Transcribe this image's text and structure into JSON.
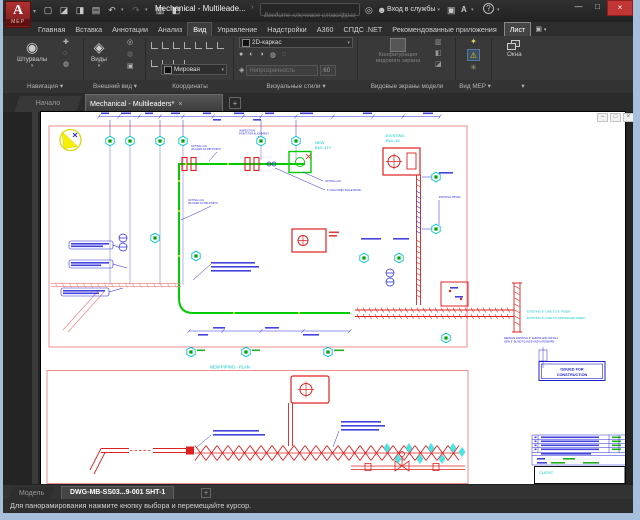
{
  "window": {
    "title": "Mechanical - Multileade..."
  },
  "titlebar": {
    "logo": "A",
    "logo_sub": "MEP",
    "search_placeholder": "Введите ключевое слово/фразу",
    "signin_label": "Вход в службы"
  },
  "icons": {
    "new": "▢",
    "open": "◪",
    "save": "◨",
    "print": "▤",
    "undo": "↶",
    "redo": "↷",
    "sheetset": "▥",
    "props": "◧",
    "dd": "▾",
    "chevron": "›",
    "search": "◎",
    "person": "☻",
    "cart": "▣",
    "store": "A",
    "help": "?",
    "minimize": "—",
    "maximize": "□",
    "close": "×",
    "wheel": "◉",
    "pan": "✚",
    "orbit": "◌",
    "zoom": "◍",
    "cube": "◈",
    "camera": "▣",
    "vs1": "●",
    "vs2": "◐",
    "vs3": "◑",
    "vs4": "◍",
    "vs5": "◌",
    "bulb": "✦",
    "warning": "⚠",
    "flower": "✳",
    "child_min": "–",
    "child_restore": "□",
    "child_close": "×"
  },
  "ribbon_tabs": [
    {
      "label": "Главная"
    },
    {
      "label": "Вставка"
    },
    {
      "label": "Аннотации"
    },
    {
      "label": "Анализ"
    },
    {
      "label": "Вид"
    },
    {
      "label": "Управление"
    },
    {
      "label": "Надстройки"
    },
    {
      "label": "A360"
    },
    {
      "label": "СПДС .NET"
    },
    {
      "label": "Рекомендованные приложения"
    },
    {
      "label": "Лист"
    }
  ],
  "ribbon": {
    "navigation": {
      "label": "Навигация ▾",
      "button": "Штурвалы"
    },
    "appearance": {
      "label": "Внешний вид ▾",
      "button": "Виды"
    },
    "coordinates": {
      "label": "Координаты",
      "value": "Мировая"
    },
    "visual_styles": {
      "label": "Визуальные стили ▾",
      "style": "2D-каркас",
      "opacity_placeholder": "Непрозрачность",
      "opacity_value": "60"
    },
    "model_viewports": {
      "label": "Видовые экраны модели",
      "button": "Конфигурация видового экрана"
    },
    "mep_view": {
      "label": "Вид MEP ▾"
    },
    "windows": {
      "label": "▾",
      "button": "Окна"
    }
  },
  "file_tabs": {
    "start": "Начало",
    "active": "Mechanical - Multileaders*",
    "new": "+"
  },
  "drawing": {
    "labels": {
      "existing_bul15": [
        "EXISTING",
        "BUL-15"
      ],
      "new_bul1ty": [
        "NEW",
        "BUL-1TY"
      ],
      "inspection": [
        "INSPECTION",
        "POINT FOR ALIGNMENT"
      ],
      "lifting_lug_top": [
        "LIFTING LUG",
        "(PLACED AT MID POINT)"
      ],
      "lifting_lug_mid": [
        "LIFTING LUG",
        "(PLACED AT MID POINT)"
      ],
      "lifting_lug_short": "LIFTING LUG",
      "spectacle_blind": "6\" HIGH SPECTACLE BLIND",
      "existing_piping": "EXISTING PIPING",
      "existing_line1": "EXISTING 6\" LINE TO 6\" RISER",
      "existing_line2": "EXISTING 6\" LINE TO SPRINKLER RISER",
      "remove_note": [
        "REMOVE EXISTING 6\" ELBOW AND INSTALL",
        "NEW 6\" BLIND FLANGE AND HARDWARE"
      ],
      "new_piping_plan": "NEW PIPING - PLAN",
      "issued": [
        "ISSUED FOR",
        "CONSTRUCTION"
      ],
      "client": "CLIENT"
    }
  },
  "layout_tabs": {
    "model": "Модель",
    "active": "DWG-MB-SS03...9-001 SHT-1",
    "new": "+"
  },
  "statusbar": {
    "message": "Для панорамирования нажмите кнопку выбора и перемещайте курсор."
  },
  "colors": {
    "new_piping_green": "#00cc00",
    "demo_red": "#e02020",
    "annotation_blue": "#2828d8",
    "callout_cyan": "#00c8c8",
    "sheet_border_salmon": "#ef8d8d",
    "north_arrow_yellow": "#f0e800",
    "canvas_white": "#ffffff",
    "window_border_blue": "#a6c0dc",
    "close_button_red": "#c23535"
  }
}
